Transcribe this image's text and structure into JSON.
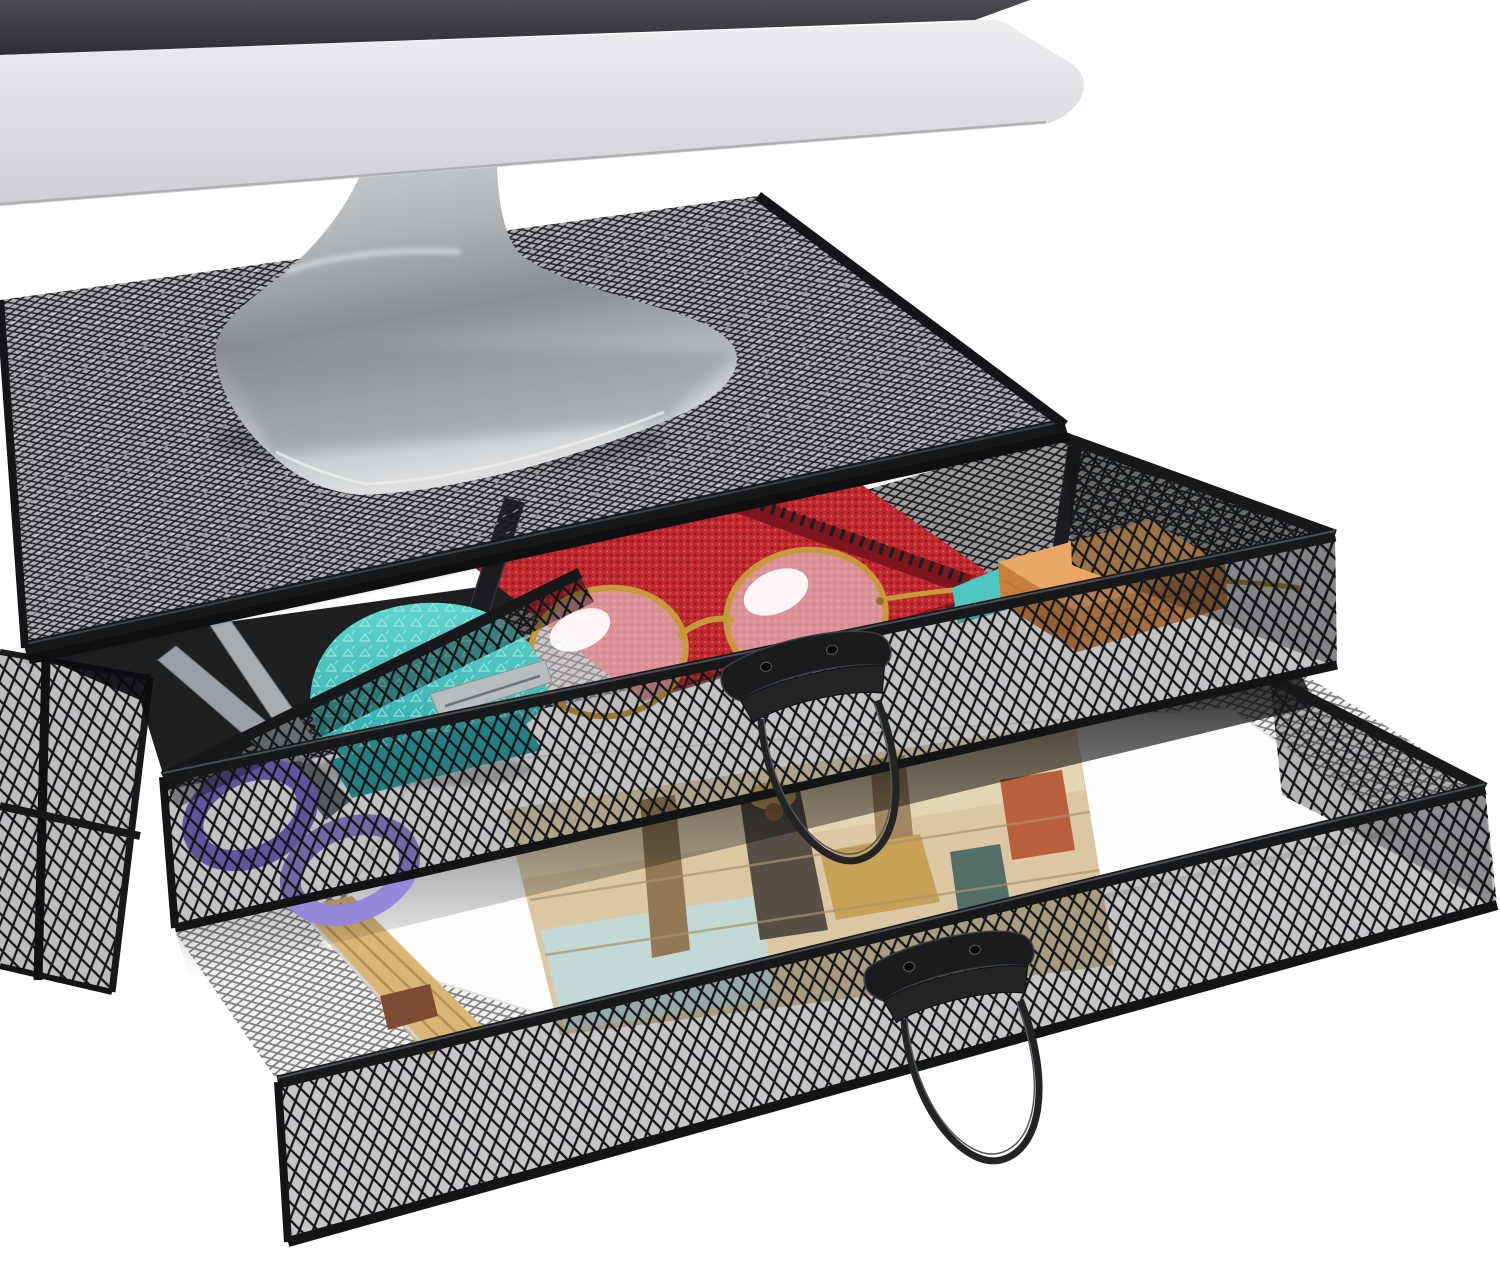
{
  "scene": {
    "description": "Product photo: two-tier black metal mesh monitor stand riser with two pulled-open mesh drawers full of desk supplies, beneath the bottom edge of a silver monitor, on a plain white background",
    "background": "#ffffff"
  },
  "palette": {
    "frame_dark": "#17181a",
    "frame_deep": "#0e0f11",
    "frame_highlight": "#4a4d51",
    "screen_dark": "#3b3d40",
    "bezel_silver": "#d9dadc",
    "aluminum": "#a9acaf",
    "interior_paper_base": "#f4f3f1",
    "paper_white": "#fdfdfd",
    "paper_sheet_edge": "#e2dfda",
    "paper_stack_tan": "#d9b576",
    "paper_stack_line": "#b08a4e",
    "paper_stack_accent": "#7e4a33",
    "painting_base": "#d9c49d",
    "painting_cream": "#e3d3ae",
    "painting_aqua": "#bdd8d2",
    "painting_column": "#8a6f4a",
    "painting_column2": "#9c7e55",
    "painting_robe": "#4a4238",
    "painting_gold": "#c39a4a",
    "painting_red": "#b35430",
    "painting_teal": "#44635c",
    "divider_dark": "#1b1c1f",
    "scissors_blade": "#9aa0a5",
    "scissors_blade2": "#a8adb2",
    "scissors_handle": "#7e6cce",
    "scissors_handle_light": "#9587d9",
    "stapler_teal": "#4cc7c4",
    "stapler_teal_dark": "#2ea6a8",
    "stapler_metal": "#b7bcbf",
    "notebook_red_dark": "#7d161d",
    "spiral_black": "#1c1d1f",
    "glasses_gold": "#c7993b",
    "lens_tint": "rgba(244,233,236,0.55)",
    "sticky_top": "#eaa766",
    "sticky_front": "#d98f4e",
    "sticky_side": "#c87f40",
    "handle_black": "#1a1b1d",
    "handle_fold": "#222426",
    "wire_dark": "#212325"
  },
  "monitor": {
    "parts": [
      "screen-bottom-strip",
      "silver-bezel",
      "curved-aluminum-stand-foot"
    ]
  },
  "riser": {
    "material": "black-metal-mesh",
    "tier_count": 2,
    "platform": {
      "name": "mesh-top-platform"
    },
    "drawers": [
      {
        "name": "top-drawer",
        "state": "pulled-open",
        "contents": [
          "scissors-purple-handles",
          "teal-mini-stapler",
          "gold-round-eyeglasses",
          "red-spiral-notebook",
          "mesh-dividers",
          "orange-sticky-note-pad"
        ]
      },
      {
        "name": "bottom-drawer",
        "state": "pulled-open",
        "contents": [
          "white-paper-sheets",
          "classical-art-print",
          "tan-paper-stack"
        ]
      }
    ],
    "handle_style": "curved-black-metal-pull-with-wire-bail"
  }
}
